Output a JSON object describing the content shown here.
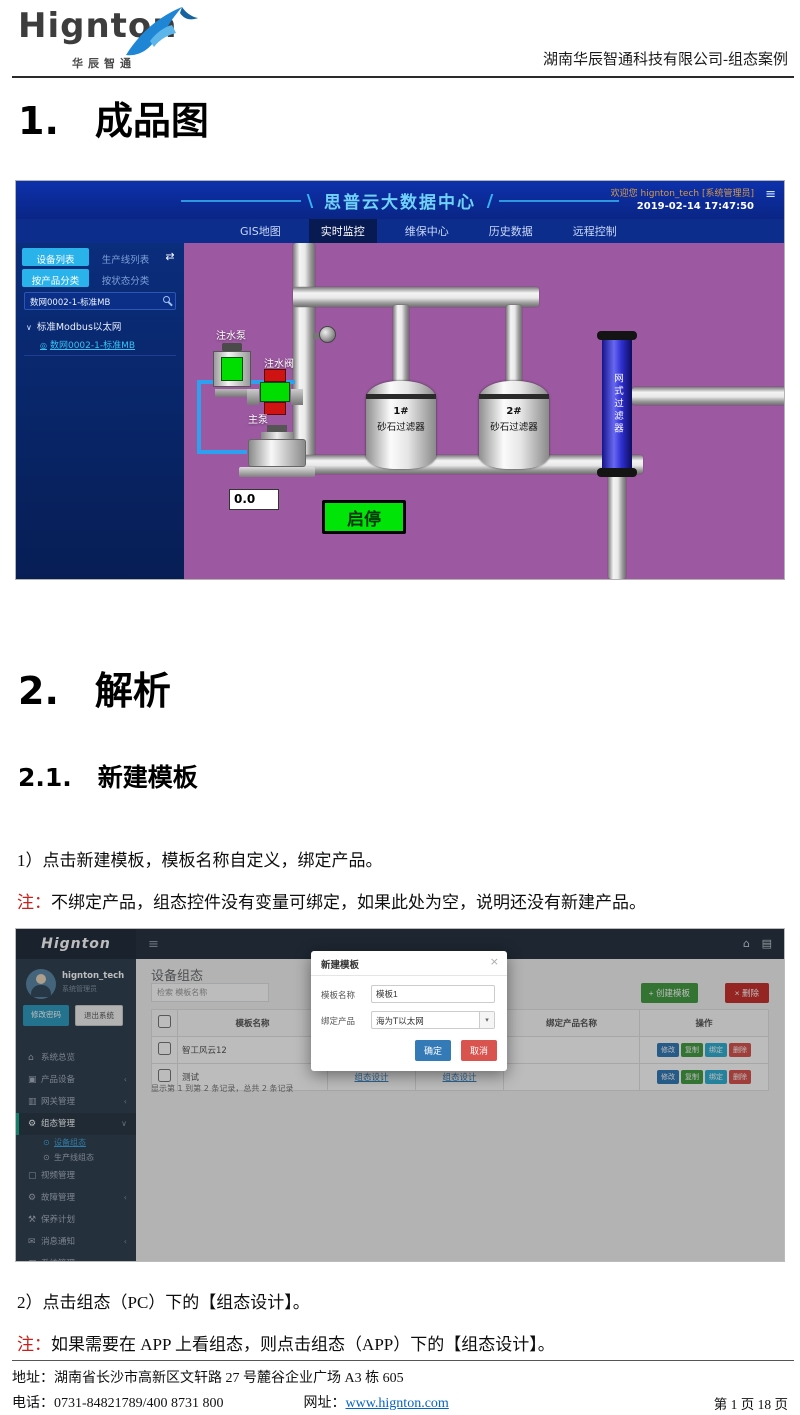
{
  "icons": {
    "hamburger": "≡",
    "swap": "⇄",
    "chevron_down": "∨",
    "chevron_left": "‹",
    "caret_down": "▾",
    "home": "⌂",
    "cube": "▣",
    "book": "▥",
    "gears": "⚙",
    "bullet": "⊙",
    "monitor": "▢",
    "wrench": "⚒",
    "mail": "✉",
    "screen": "▦",
    "grid": "▤",
    "close": "×",
    "plus": "+",
    "tag": "◎"
  },
  "doc": {
    "header": {
      "logo": "Hignton",
      "logo_sub": "华辰智通",
      "right_text": "湖南华辰智通科技有限公司-组态案例"
    },
    "h1_num": "1.",
    "h1_title": "成品图",
    "h2_num": "2.",
    "h2_title": "解析",
    "h21_num": "2.1.",
    "h21_title": "新建模板",
    "para1": "1）点击新建模板，模板名称自定义，绑定产品。",
    "note1_label": "注：",
    "note1_text": "不绑定产品，组态控件没有变量可绑定，如果此处为空，说明还没有新建产品。",
    "para2": "2）点击组态（PC）下的【组态设计】。",
    "note2_label": "注：",
    "note2_text": "如果需要在 APP 上看组态，则点击组态（APP）下的【组态设计】。",
    "footer": {
      "address": "地址：湖南省长沙市高新区文轩路 27 号麓谷企业广场 A3 栋 605",
      "phone": "电话：0731-84821789/400 8731 800",
      "site_label": "网址：",
      "site_url": "www.hignton.com",
      "page_info": "第 1 页 18 页"
    }
  },
  "scada": {
    "title": "思普云大数据中心",
    "welcome": "欢迎您  hignton_tech [系统管理员]",
    "datetime": "2019-02-14 17:47:50",
    "nav": [
      {
        "label": "GIS地图"
      },
      {
        "label": "实时监控"
      },
      {
        "label": "维保中心"
      },
      {
        "label": "历史数据"
      },
      {
        "label": "远程控制"
      }
    ],
    "sidebar": {
      "tab_device": "设备列表",
      "tab_line": "生产线列表",
      "tab_by_product": "按产品分类",
      "tab_by_status": "按状态分类",
      "search_value": "数网0002-1-标准MB",
      "tree_parent": "标准Modbus以太网",
      "tree_child": "数网0002-1-标准MB"
    },
    "diagram": {
      "pump_label": "注水泵",
      "valve_label": "注水阀",
      "main_pump_label": "主泵",
      "tank1_no": "1#",
      "tank1_name": "砂石过滤器",
      "tank2_no": "2#",
      "tank2_name": "砂石过滤器",
      "net_filter": "网式过滤器",
      "reading": "0.0",
      "start_stop": "启停"
    }
  },
  "admin": {
    "logo": "Hignton",
    "user": {
      "name": "hignton_tech",
      "role": "系统管理员",
      "change_pwd": "修改密码",
      "logout": "退出系统"
    },
    "menu": [
      {
        "label": "系统总览"
      },
      {
        "label": "产品设备"
      },
      {
        "label": "网关管理"
      },
      {
        "label": "组态管理"
      },
      {
        "label": "设备组态"
      },
      {
        "label": "生产线组态"
      },
      {
        "label": "视频管理"
      },
      {
        "label": "故障管理"
      },
      {
        "label": "保养计划"
      },
      {
        "label": "消息通知"
      },
      {
        "label": "系统管理"
      }
    ],
    "page_title": "设备组态",
    "search_placeholder": "检索 模板名称",
    "create_btn": "创建模板",
    "delete_btn": "删除",
    "table": {
      "headers": [
        "模板名称",
        "组态（PC）",
        "组态（APP）",
        "绑定产品名称",
        "操作"
      ],
      "rows": [
        {
          "name": "智工风云12",
          "pc_link": "组态设计",
          "app_link": "组态设计",
          "product": ""
        },
        {
          "name": "测试",
          "pc_link": "组态设计",
          "app_link": "组态设计",
          "product": ""
        }
      ],
      "action_labels": [
        "修改",
        "复制",
        "绑定",
        "删除"
      ],
      "pagination": "显示第 1 到第 2 条记录，总共 2 条记录"
    },
    "modal": {
      "title": "新建模板",
      "name_label": "模板名称",
      "name_value": "模板1",
      "product_label": "绑定产品",
      "product_value": "海为T以太网",
      "ok": "确定",
      "cancel": "取消"
    }
  }
}
